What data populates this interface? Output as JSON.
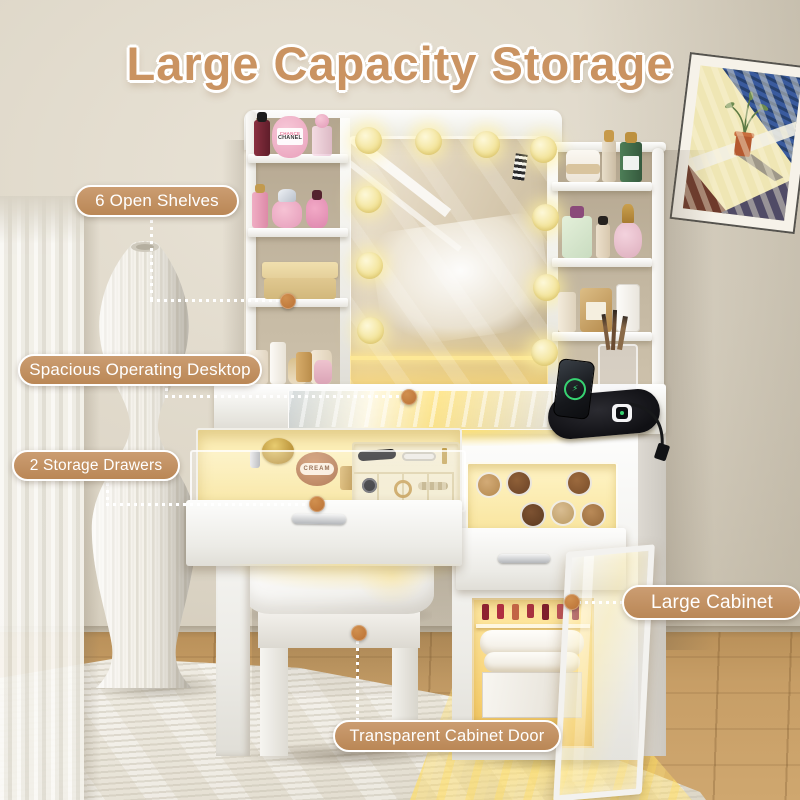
{
  "title": {
    "text": "Large Capacity Storage",
    "color": "#ca9361",
    "outline_color": "#ffffff"
  },
  "callouts": [
    {
      "id": "open-shelves",
      "label": "6 Open Shelves"
    },
    {
      "id": "operating-desktop",
      "label": "Spacious Operating Desktop"
    },
    {
      "id": "storage-drawers",
      "label": "2 Storage Drawers"
    },
    {
      "id": "large-cabinet",
      "label": "Large Cabinet"
    },
    {
      "id": "transparent-cabinet-door",
      "label": "Transparent Cabinet Door"
    }
  ],
  "product_labels": {
    "perfume_label_top": "CHANCE",
    "perfume_label_bottom": "CHANEL",
    "blush_label": "CREAM"
  },
  "style": {
    "pill_fill": "#c1905f",
    "pill_border": "#ffffff",
    "pill_text": "#ffffff",
    "connector_dot": "#c07a3e",
    "connector_line": "#ffffff",
    "led_bulb": "#f6e9a6",
    "drawer_glow": "#ffe9a8",
    "wood_floor": "#c59a63",
    "wall": "#d8d1c2"
  }
}
